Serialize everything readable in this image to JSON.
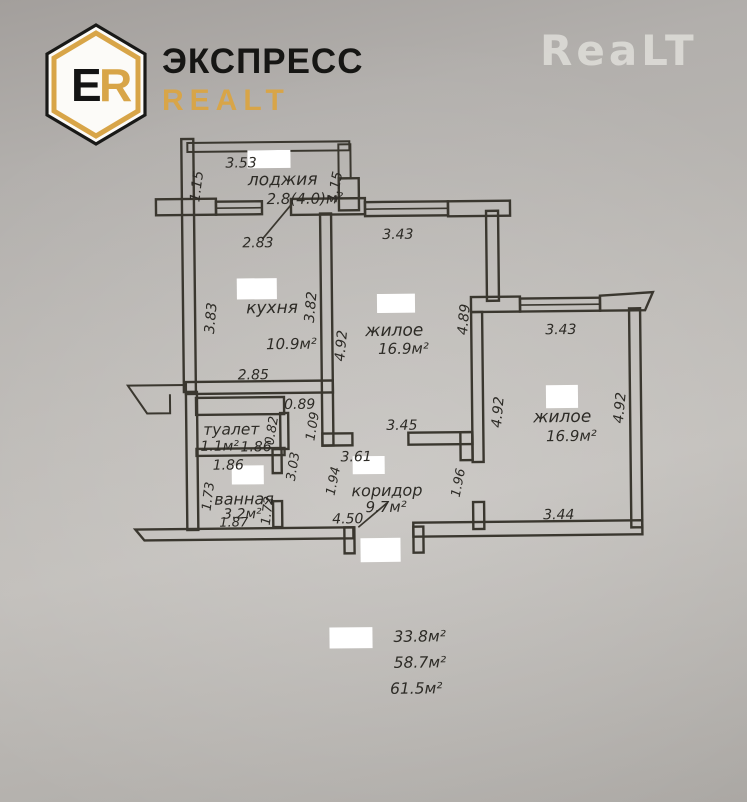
{
  "colors": {
    "brand_gold": "#d8a548",
    "ink": "#3a372f",
    "paper": "#b7b4b1"
  },
  "header": {
    "logo_letter_e": "E",
    "logo_letter_r": "R",
    "brand_line1": "ЭКСПРЕСС",
    "brand_line2": "REALT",
    "watermark": "ReaLT"
  },
  "floorplan": {
    "rooms": {
      "loggia": {
        "name": "лоджия",
        "area": "2.8(4.0)м²"
      },
      "kitchen": {
        "name": "кухня",
        "area": "10.9м²"
      },
      "living1": {
        "name": "жилое",
        "area": "16.9м²"
      },
      "living2": {
        "name": "жилое",
        "area": "16.9м²"
      },
      "toilet": {
        "name": "туалет",
        "area": "1.1м²"
      },
      "bath": {
        "name": "ванная",
        "area": "3.2м²"
      },
      "corridor": {
        "name": "коридор",
        "area": "9.7м²"
      }
    },
    "dims": {
      "loggia_top": "3.53",
      "loggia_left": "1.15",
      "loggia_right": "1.15",
      "kitchen_top": "2.83",
      "kitchen_left": "3.83",
      "kitchen_right": "3.82",
      "kitchen_bottom": "2.85",
      "niche_width": "0.89",
      "niche_height": "1.09",
      "living1_top": "3.43",
      "living1_left": "4.92",
      "living1_right": "4.89",
      "living1_bottom": "3.45",
      "living2_top": "3.43",
      "living2_left": "4.92",
      "living2_right": "4.92",
      "living2_bottom": "3.44",
      "toilet_area_width": "1.86",
      "toilet_height": "0.82",
      "bath_top": "1.86",
      "bath_side": "3.03",
      "bath_left": "1.73",
      "bath_right": "1.72",
      "bath_bottom": "1.87",
      "corridor_top": "3.61",
      "corridor_left": "1.94",
      "corridor_right": "1.96",
      "corridor_length": "4.50"
    },
    "totals": {
      "living_total": "33.8м²",
      "area_total": "58.7м²",
      "full_total": "61.5м²"
    }
  }
}
